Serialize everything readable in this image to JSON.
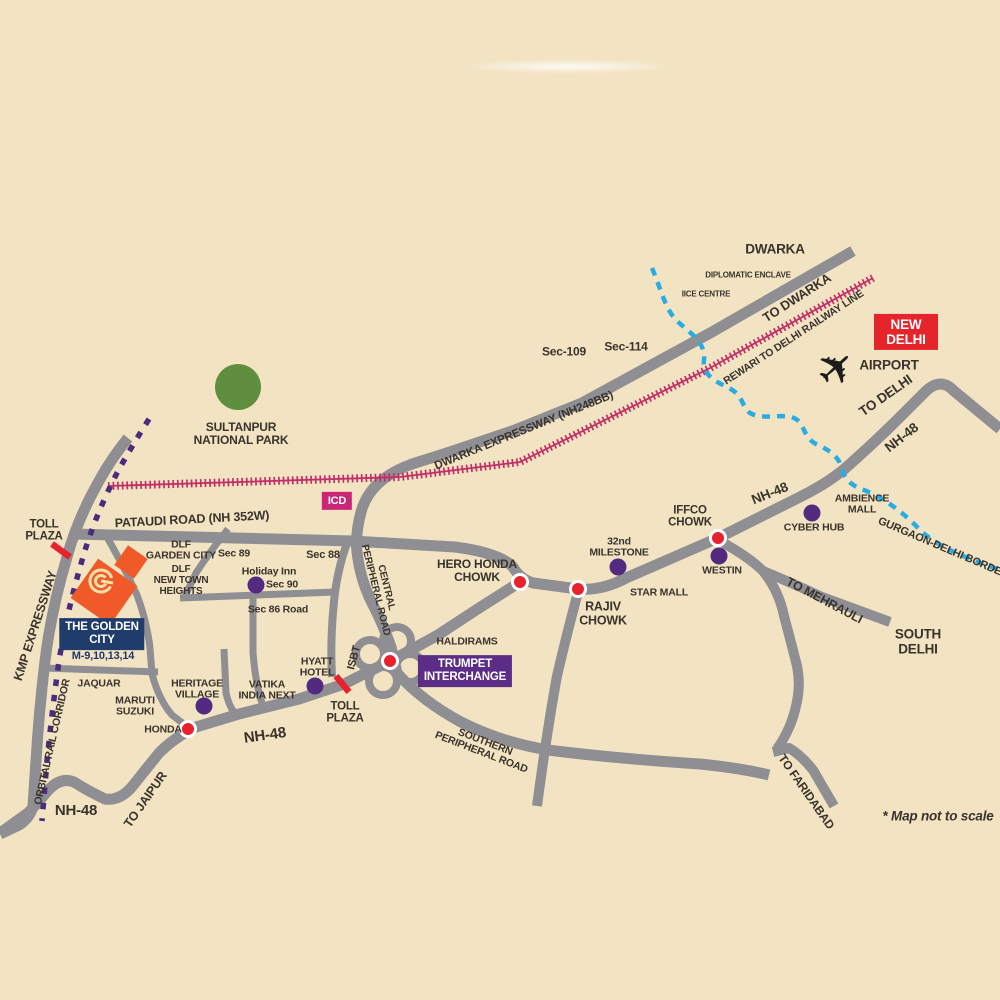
{
  "map": {
    "note": "* Map not to scale",
    "project": {
      "badge": "THE GOLDEN\nCITY",
      "sectors": "M-9,10,13,14",
      "logo_letter": "G"
    },
    "badges": {
      "new_delhi": "NEW\nDELHI",
      "icd": "ICD",
      "trumpet_interchange": "TRUMPET\nINTERCHANGE"
    },
    "labels": {
      "dwarka": "DWARKA",
      "diplomatic_enclave": "DIPLOMATIC ENCLAVE",
      "iice_centre": "IICE CENTRE",
      "to_dwarka": "TO DWARKA",
      "rewari_railway_line": "REWARI TO DELHI RAILWAY LINE",
      "airport": "AIRPORT",
      "to_delhi": "TO DELHI",
      "nh48_top_right": "NH-48",
      "sec_109": "Sec-109",
      "sec_114": "Sec-114",
      "dwarka_expressway": "DWARKA EXPRESSWAY (NH248BB)",
      "sultanpur_national_park": "SULTANPUR\nNATIONAL PARK",
      "pataudi_road": "PATAUDI ROAD (NH 352W)",
      "toll_plaza_west": "TOLL\nPLAZA",
      "kmp_expressway": "KMP EXPRESSWAY",
      "dlf_garden_city": "DLF\nGARDEN CITY",
      "sec_89": "Sec 89",
      "sec_88": "Sec 88",
      "dlf_new_town_heights": "DLF\nNEW TOWN\nHEIGHTS",
      "holiday_inn": "Holiday Inn",
      "sec_90": "Sec 90",
      "sec_86_road": "Sec 86 Road",
      "central_peripheral_road": "CENTRAL\nPERIPHERAL ROAD",
      "jaquar": "JAQUAR",
      "maruti_suzuki": "MARUTI\nSUZUKI",
      "honda": "HONDA",
      "heritage_village": "HERITAGE\nVILLAGE",
      "vatika_india_next": "VATIKA\nINDIA NEXT",
      "hyatt_hotel": "HYATT\nHOTEL",
      "isbt": "ISBT",
      "toll_plaza_trumpet": "TOLL\nPLAZA",
      "haldirams": "HALDIRAMS",
      "hero_honda_chowk": "HERO HONDA\nCHOWK",
      "rajiv_chowk": "RAJIV\nCHOWK",
      "milestone_32": "32nd\nMILESTONE",
      "star_mall": "STAR MALL",
      "iffco_chowk": "IFFCO\nCHOWK",
      "westin": "WESTIN",
      "cyber_hub": "CYBER HUB",
      "ambience_mall": "AMBIENCE\nMALL",
      "nh48_mid": "NH-48",
      "gurgaon_delhi_border": "GURGAON-DELHI BORDER",
      "to_mehrauli": "TO MEHRAULI",
      "south_delhi": "SOUTH DELHI",
      "southern_peripheral_road": "SOUTHERN\nPERIPHERAL ROAD",
      "to_faridabad": "TO FARIDABAD",
      "nh48_south": "NH-48",
      "to_jaipur": "TO JAIPUR",
      "nh48_southwest": "NH-48",
      "orbital_rail_corridor": "ORBITAL RAIL CORRIDOR",
      "map_note": "* Map not to scale"
    },
    "icons": {
      "airplane": "✈"
    },
    "colors": {
      "background": "#f2e4c3",
      "road_gray": "#8e8e93",
      "railway_pink": "#c22f67",
      "border_dashed_cyan": "#2aace2",
      "orbital_rail_purple": "#4b2b7d",
      "landmark_dot_purple": "#522b80",
      "junction_dot_red": "#e8222d",
      "badge_red": "#e5242b",
      "badge_magenta": "#c92678",
      "badge_purple": "#5b2d87",
      "badge_navy": "#1f3c6b",
      "project_orange": "#f05a28",
      "park_green": "#5f8f3e",
      "logo_cream": "#f3e0a8",
      "text_dark": "#3a332c"
    }
  }
}
